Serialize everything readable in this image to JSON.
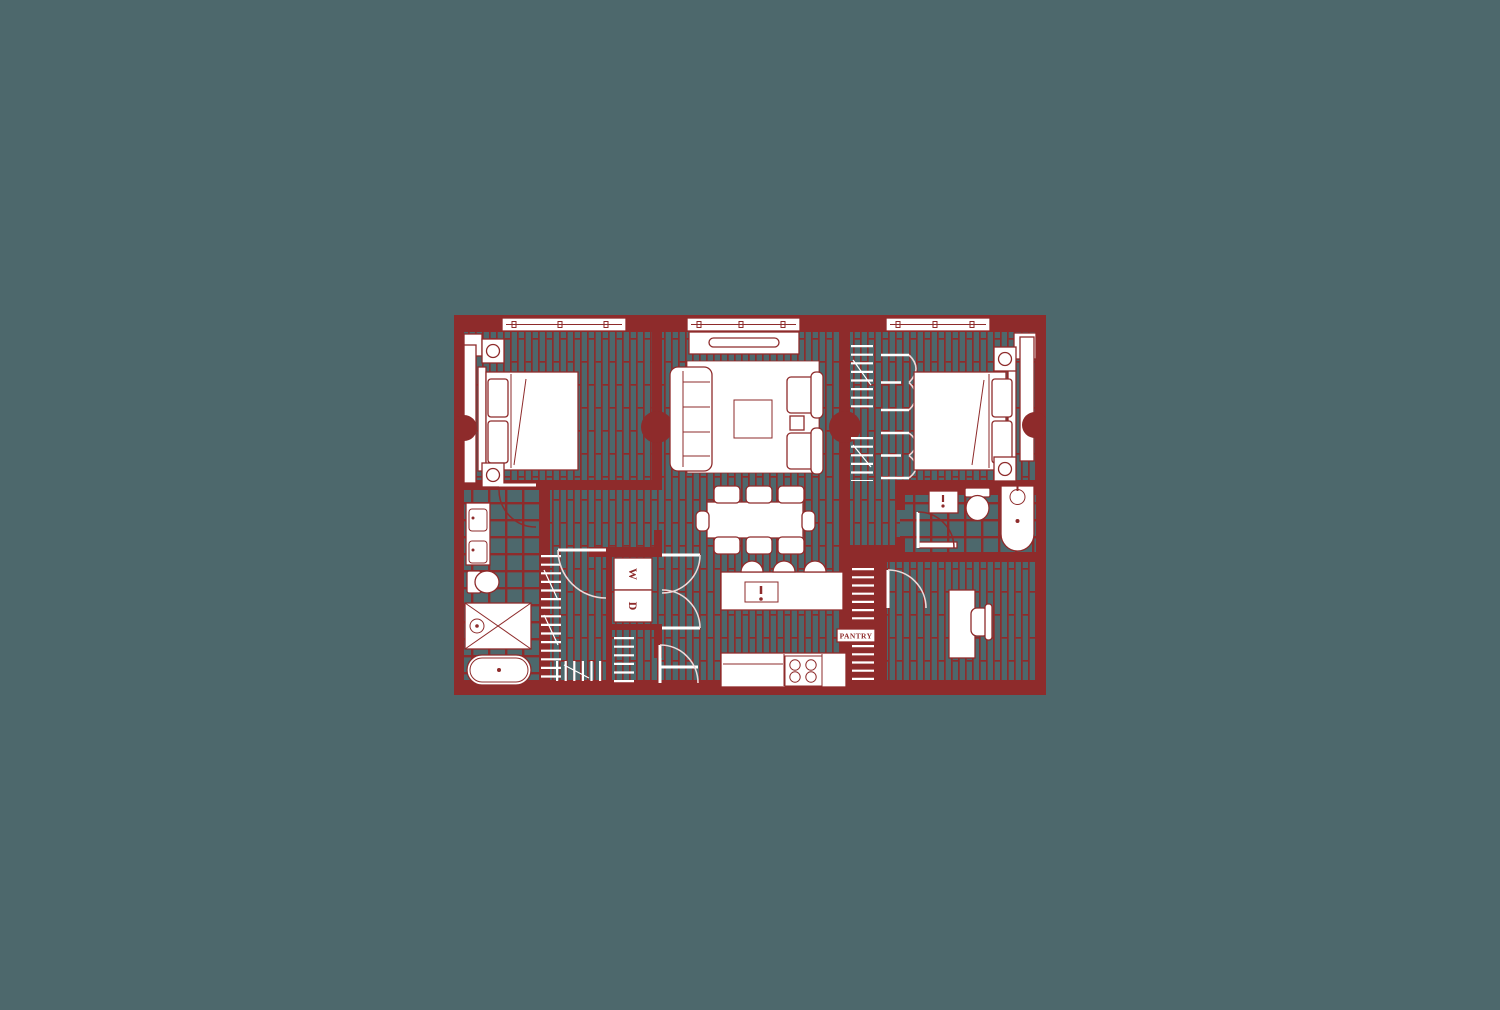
{
  "floorplan": {
    "colors": {
      "wall": "#8e2b2b",
      "floor": "#4d686c",
      "fixture": "#ffffff",
      "door_arc": "#eddada"
    },
    "labels": {
      "washer": "W",
      "dryer": "D",
      "pantry": "PANTRY"
    }
  }
}
